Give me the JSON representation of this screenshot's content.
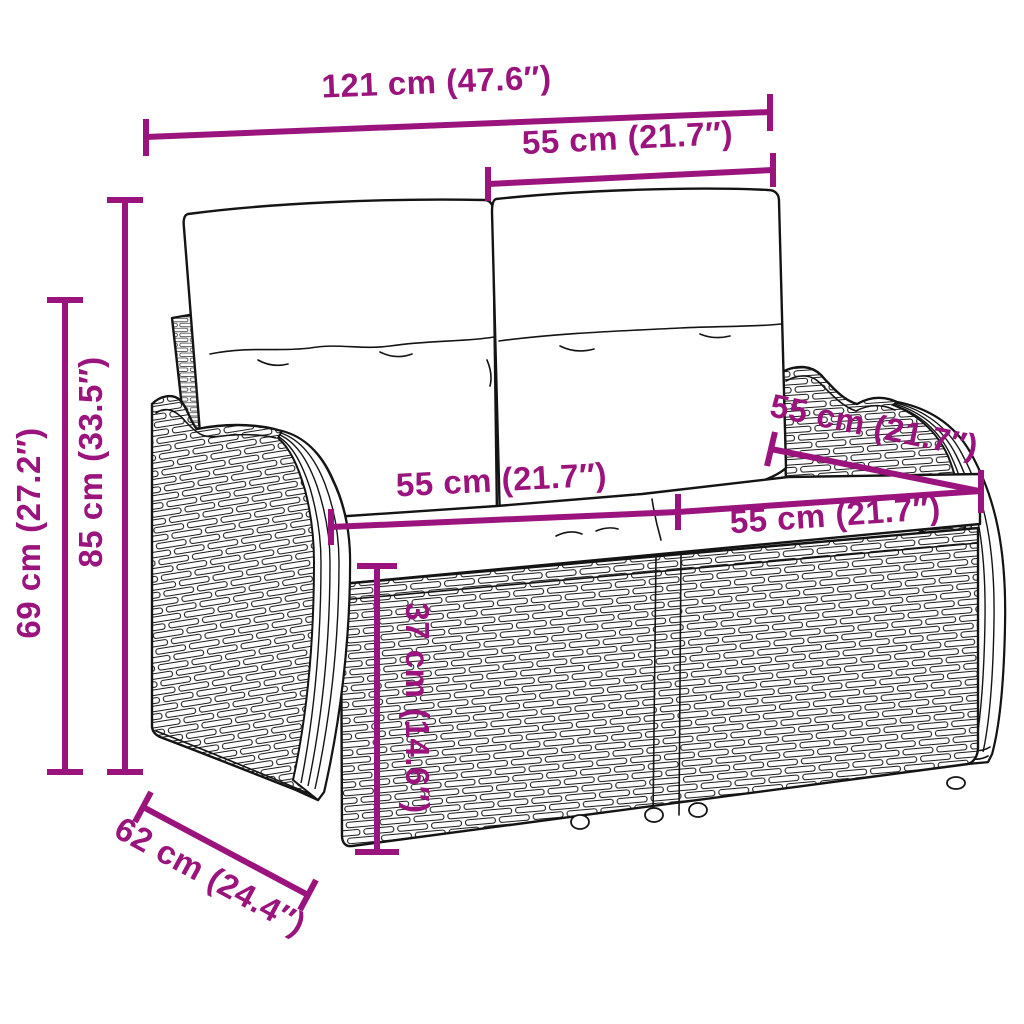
{
  "page": {
    "type": "product dimension diagram",
    "product": "poly rattan 2-seater garden bench with back and seat cushions",
    "background": "#ffffff"
  },
  "colors": {
    "dimension_accent": "#9B147D",
    "line_art": "#141414",
    "cushion_fill": "#ffffff"
  },
  "dimensions": {
    "overall_width": {
      "cm": 121,
      "inches": 47.6,
      "label": "121 cm (47.6″)"
    },
    "backrest_top_width": {
      "cm": 55,
      "inches": 21.7,
      "label": "55 cm (21.7″)"
    },
    "total_height": {
      "cm": 85,
      "inches": 33.5,
      "label": "85 cm (33.5″)"
    },
    "armrest_height": {
      "cm": 69,
      "inches": 27.2,
      "label": "69 cm (27.2″)"
    },
    "seat_depth_diagonal": {
      "cm": 55,
      "inches": 21.7,
      "label": "55 cm (21.7″)"
    },
    "seat_width_left": {
      "cm": 55,
      "inches": 21.7,
      "label": "55 cm (21.7″)"
    },
    "seat_width_right": {
      "cm": 55,
      "inches": 21.7,
      "label": "55 cm (21.7″)"
    },
    "seat_height": {
      "cm": 37,
      "inches": 14.6,
      "label": "37 cm (14.6″)"
    },
    "overall_depth": {
      "cm": 62,
      "inches": 24.4,
      "label": "62 cm (24.4″)"
    }
  }
}
